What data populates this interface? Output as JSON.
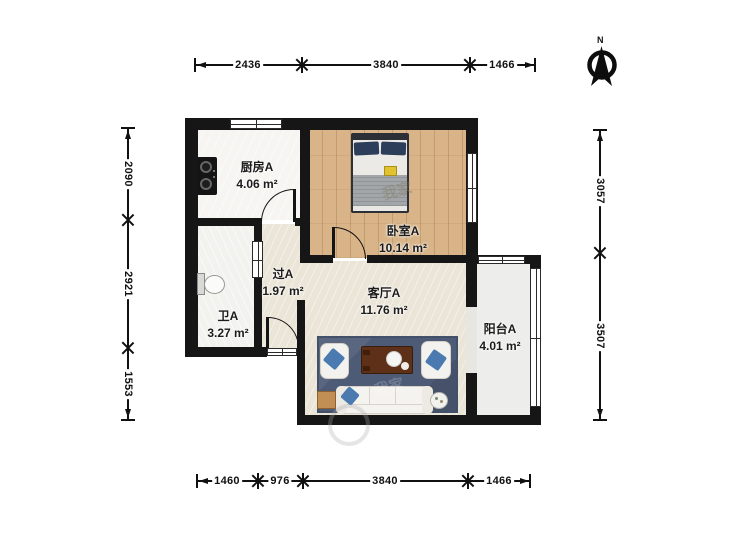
{
  "rooms": [
    {
      "id": "kitchen",
      "name": "厨房A",
      "area": "4.06 m²"
    },
    {
      "id": "bedroom",
      "name": "卧室A",
      "area": "10.14 m²"
    },
    {
      "id": "hallway",
      "name": "过A",
      "area": "1.97 m²"
    },
    {
      "id": "bathroom",
      "name": "卫A",
      "area": "3.27 m²"
    },
    {
      "id": "living",
      "name": "客厅A",
      "area": "11.76 m²"
    },
    {
      "id": "balcony",
      "name": "阳台A",
      "area": "4.01 m²"
    }
  ],
  "dimensions": {
    "top": [
      "2436",
      "3840",
      "1466"
    ],
    "bottom": [
      "1460",
      "976",
      "3840",
      "1466"
    ],
    "left": [
      "2090",
      "2921",
      "1553"
    ],
    "right": [
      "3057",
      "3507"
    ]
  },
  "compass": {
    "north_label": "N"
  },
  "watermark": {
    "text": "我家"
  },
  "colors": {
    "wall": "#161616",
    "wood_floor": "#d8b488",
    "tile_floor": "#ebe5d8",
    "rug": "#4d5b76",
    "pillow_blue": "#4b7ab0",
    "table_wood": "#5e3018"
  }
}
